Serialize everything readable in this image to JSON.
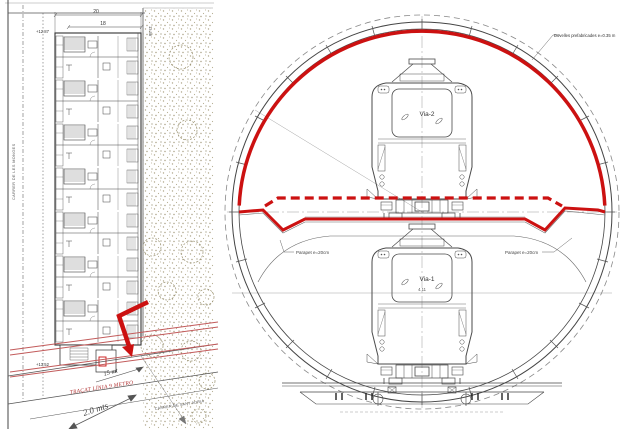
{
  "colors": {
    "red_accent": "#cc1111",
    "route_red": "#c25b5b",
    "drawing_line": "#4a4a4a",
    "stipple": "#b0a78c"
  },
  "left_plan": {
    "street_left_label": "CARRER DE LES MONGES",
    "street_bottom_label": "CARRER DE SANT ADRIÀ",
    "metro_route_label": "TRAÇAT LÍNIA 9 METRO",
    "distance_annotation_1": "15 mt",
    "distance_annotation_2": "2.0 mts",
    "elevation_top": "+12.87",
    "elevation_bottom": "+13.52",
    "dimension_right": "13.58",
    "dimension_top_outer": "20",
    "dimension_top_inner": "18"
  },
  "tunnel_section": {
    "lining_label": "Dovelles prefabricades e=0.35 m",
    "slab_label_left": "Parapet e=20cm",
    "slab_label_right": "Parapet e=20cm",
    "upper_track_label": "Via-2",
    "lower_track_label": "Via-1",
    "lower_gauge_dimension": "4.11"
  }
}
